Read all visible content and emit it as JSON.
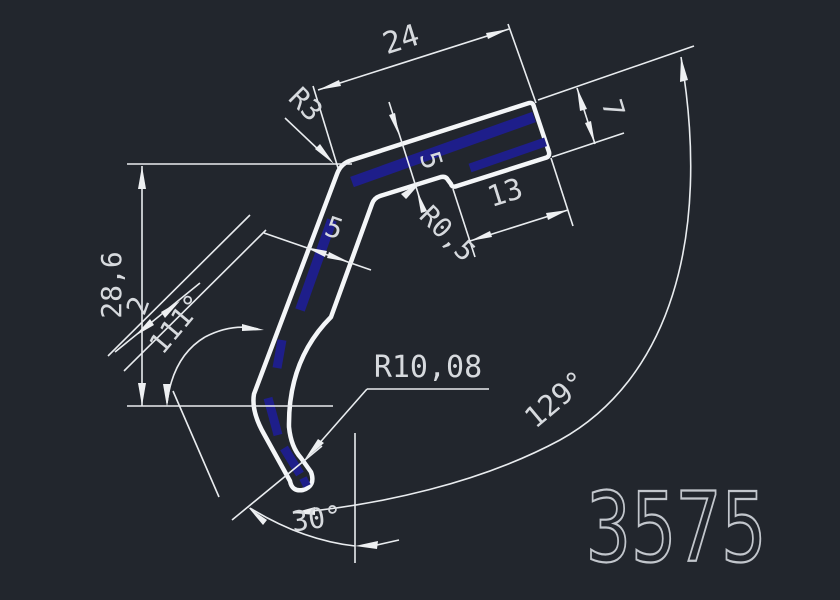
{
  "part_number": "3575",
  "colors": {
    "background": "#22262d",
    "line": "#e9ecef",
    "profile_stroke": "#f4f6f8",
    "hatch_blue": "#1e1e8a",
    "dim_text": "#d7dade",
    "part_number_stroke": "#c2c6cc"
  },
  "dims": {
    "len24": "24",
    "thick7": "7",
    "len13": "13",
    "thick5_top": "5",
    "thick5_arm": "5",
    "offset2": "2",
    "height286": "28,6",
    "r3": "R3",
    "r05": "R0,5",
    "r1008": "R10,08",
    "angle111": "111°",
    "angle129": "129°",
    "angle30": "30°"
  }
}
